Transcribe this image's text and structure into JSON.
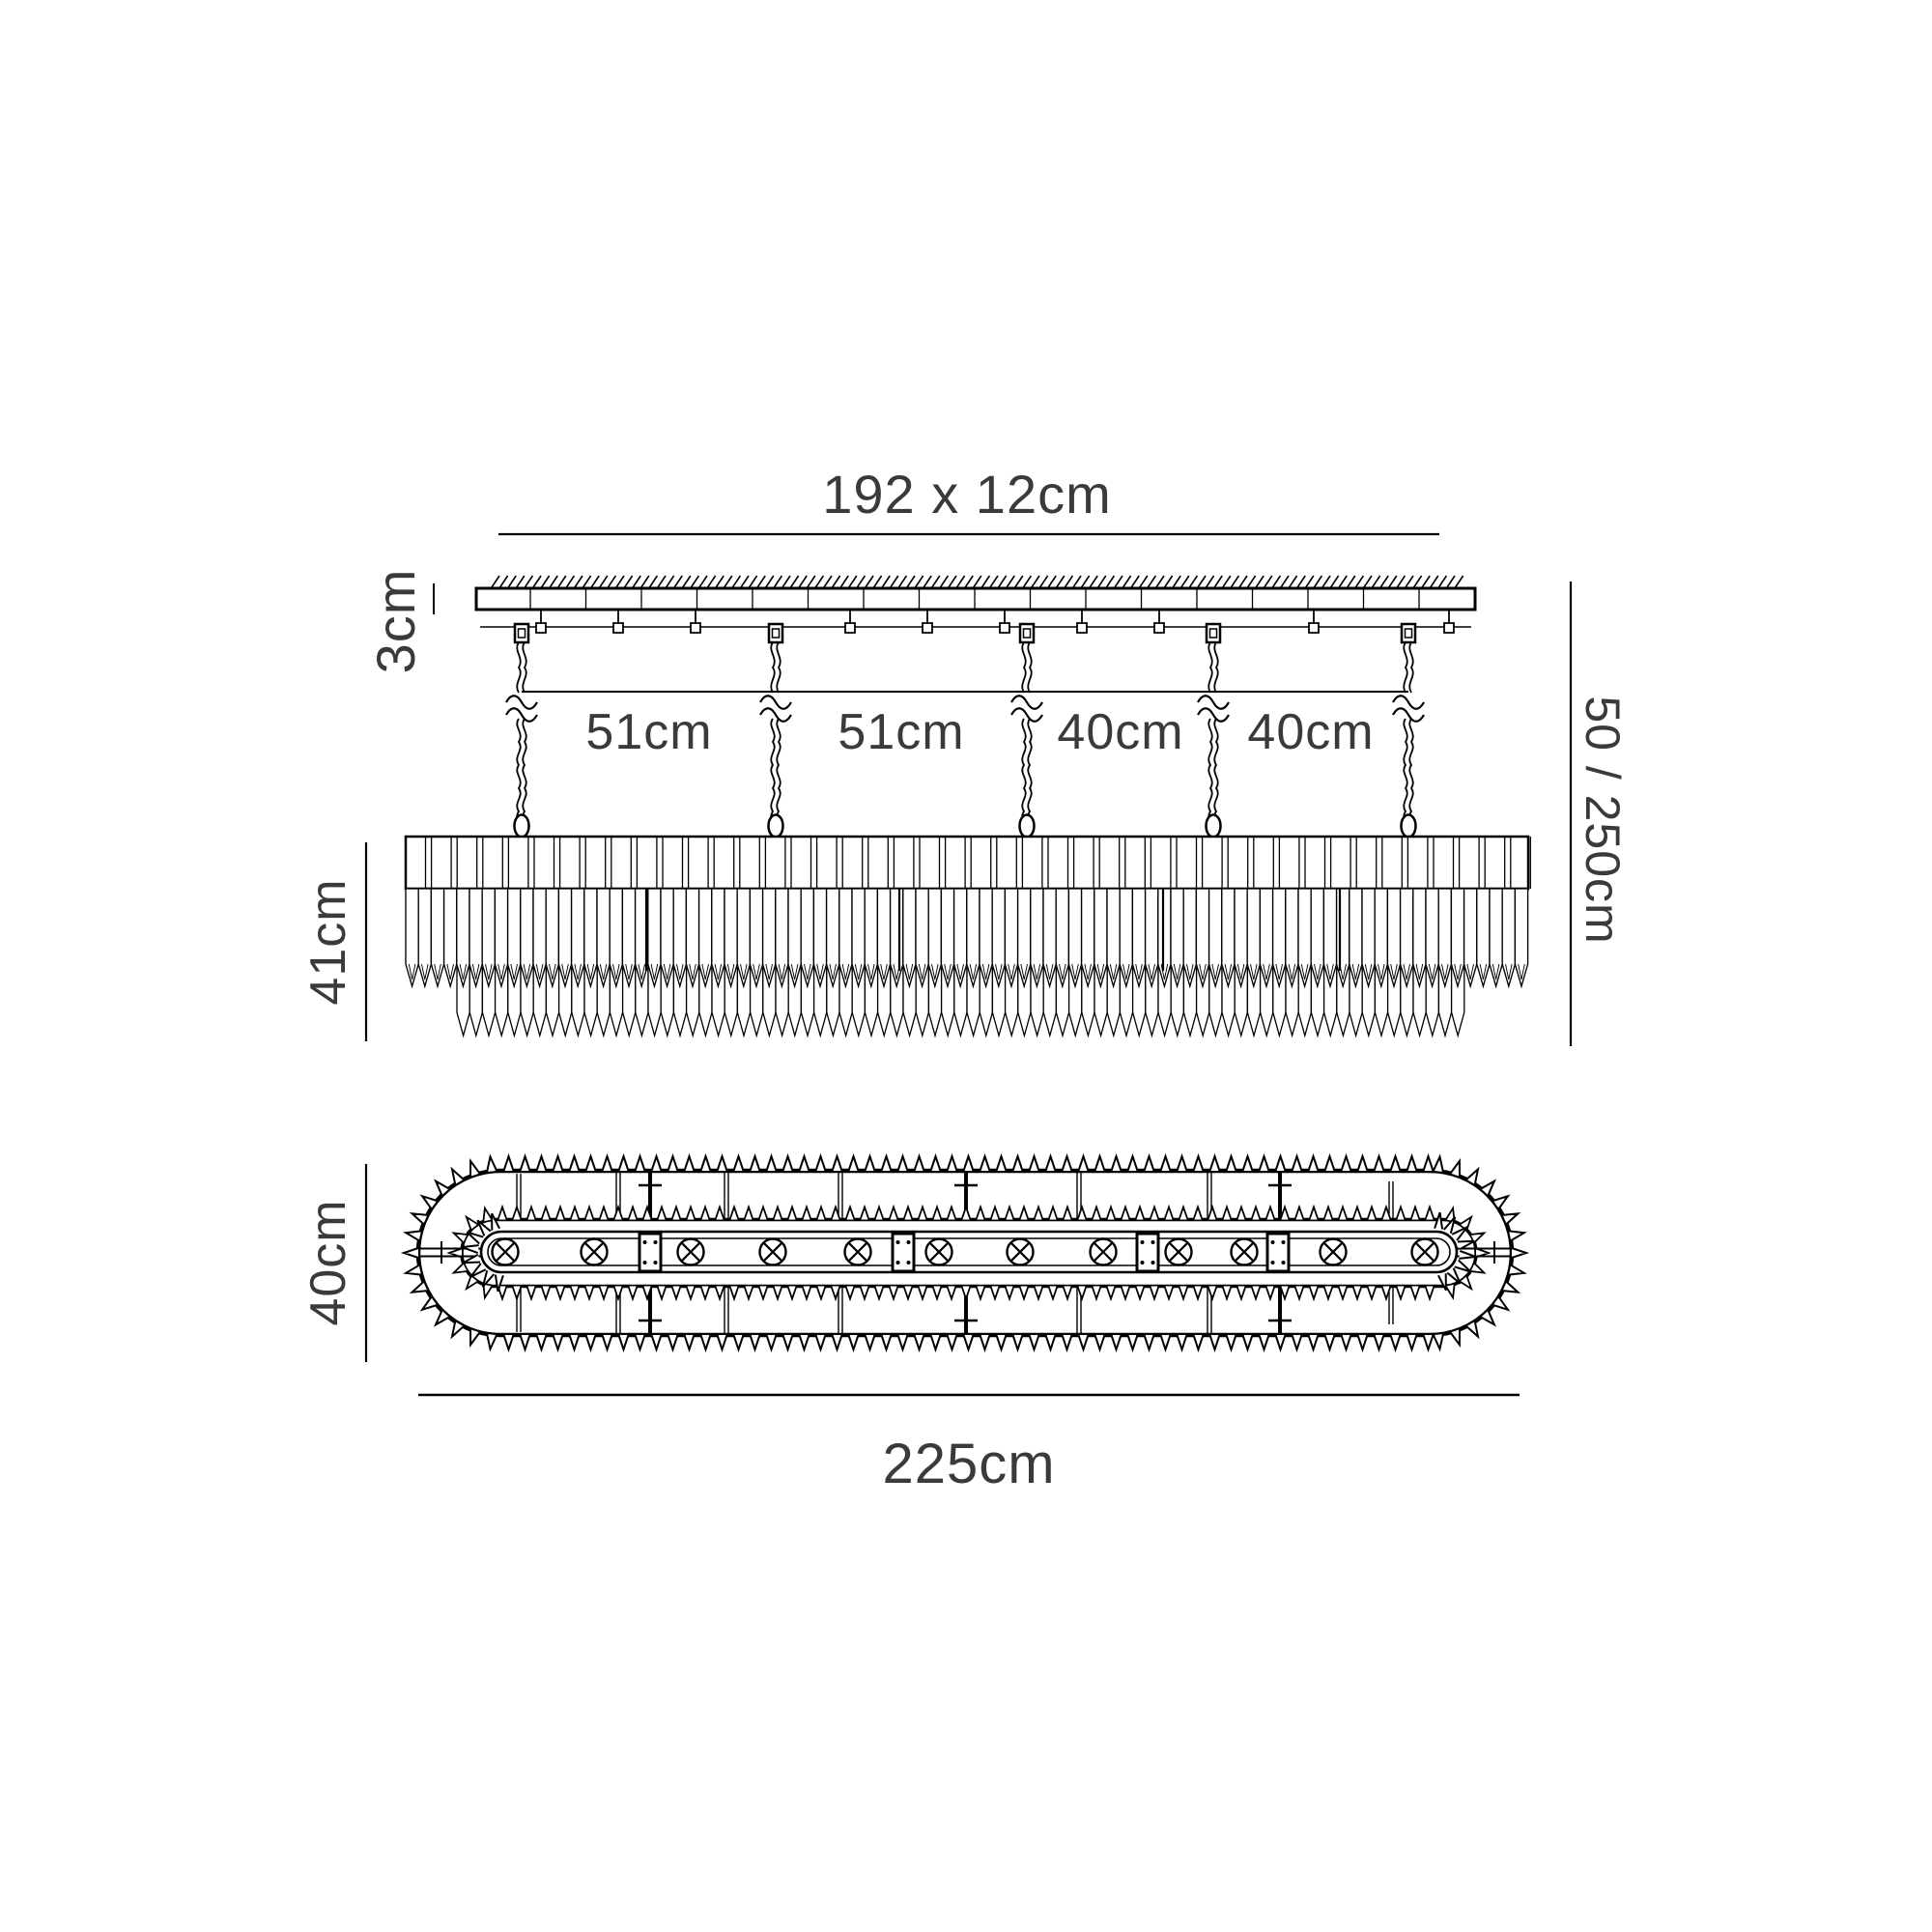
{
  "diagram": {
    "side_view": {
      "canopy_dimension_label": "192 x 12cm",
      "canopy_depth_label": "3cm",
      "chain_spacing_labels": [
        "51cm",
        "51cm",
        "40cm",
        "40cm"
      ],
      "drop_height_label": "50 / 250cm",
      "body_height_label": "41cm",
      "chain_count": 5
    },
    "plan_view": {
      "width_label": "225cm",
      "depth_label": "40cm",
      "lamp_count": 12,
      "lamp_icon": "circled-cross"
    },
    "colors": {
      "line": "#000000",
      "text": "#3a3a3a",
      "background": "#ffffff"
    }
  }
}
